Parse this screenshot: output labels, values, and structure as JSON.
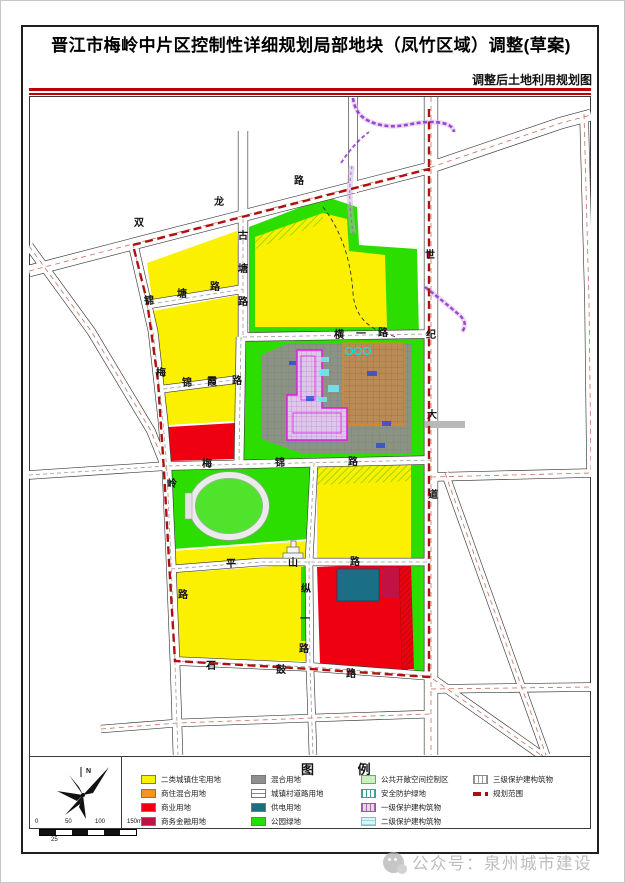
{
  "page": {
    "title": "晋江市梅岭中片区控制性详细规划局部地块（凤竹区域）调整(草案)",
    "subtitle": "调整后土地利用规划图",
    "watermark": "公众号：泉州城市建设",
    "accent_color": "#C00000",
    "boundary_color": "#B01010"
  },
  "map": {
    "road_labels": [
      {
        "text": "双龙路",
        "x": 138,
        "y": 225,
        "dx": 80,
        "dy": -21
      },
      {
        "text": "古塘路",
        "x": 242,
        "y": 238,
        "dx": 0,
        "dy": 33
      },
      {
        "text": "锦塘路",
        "x": 148,
        "y": 303,
        "dx": 33,
        "dy": -7
      },
      {
        "text": "锦霞路",
        "x": 186,
        "y": 385,
        "dx": 25,
        "dy": -1
      },
      {
        "text": "梅岭路",
        "x": 160,
        "y": 375,
        "dx": 11,
        "dy": 111
      },
      {
        "text": "世纪大道",
        "x": 429,
        "y": 257,
        "dx": 1,
        "dy": 80
      },
      {
        "text": "横一路",
        "x": 338,
        "y": 337,
        "dx": 22,
        "dy": -1
      },
      {
        "text": "梅锦路",
        "x": 206,
        "y": 466,
        "dx": 73,
        "dy": -1
      },
      {
        "text": "平山路",
        "x": 230,
        "y": 566,
        "dx": 62,
        "dy": -1
      },
      {
        "text": "纵一路",
        "x": 305,
        "y": 591,
        "dx": -1,
        "dy": 30
      },
      {
        "text": "石鼓路",
        "x": 210,
        "y": 668,
        "dx": 70,
        "dy": 4
      }
    ],
    "colors": {
      "residential_yellow": "#FAF000",
      "mixed_orange": "#F7941D",
      "commercial_red": "#EE0011",
      "finance_crimson": "#C21244",
      "mixed_gray": "#8D9383",
      "power_teal": "#1A6E86",
      "park_green": "#2CDE00",
      "metro_purple": "#8B2FC9"
    }
  },
  "compass": {
    "north_label": "N"
  },
  "scale_bar": {
    "ticks": [
      "0",
      "50",
      "100",
      "150m"
    ],
    "sub_label": "25"
  },
  "legend": {
    "title": "图 例",
    "items": [
      {
        "label": "二类城镇住宅用地",
        "color": "#FAF000"
      },
      {
        "label": "商住混合用地",
        "color": "#F7941D"
      },
      {
        "label": "商业用地",
        "color": "#EE0011"
      },
      {
        "label": "商务金融用地",
        "color": "#C21244"
      },
      {
        "label": "混合用地",
        "color": "#8F8F8F"
      },
      {
        "label": "城镇村道路用地",
        "color": "#FFFFFF"
      },
      {
        "label": "供电用地",
        "color": "#1A6E86"
      },
      {
        "label": "公园绿地",
        "color": "#22DF00"
      },
      {
        "label": "公共开敞空间控制区",
        "color": "#CBEFC5"
      },
      {
        "label": "安全防护绿地",
        "color": "#3E9E9E"
      },
      {
        "label": "一级保护建构筑物",
        "color": "#B060B8"
      },
      {
        "label": "二级保护建构筑物",
        "color": "#9ED8DC"
      },
      {
        "label": "三级保护建构筑物",
        "color": "#9A9A9A"
      },
      {
        "label": "规划范围",
        "color": "#A51212"
      }
    ]
  }
}
